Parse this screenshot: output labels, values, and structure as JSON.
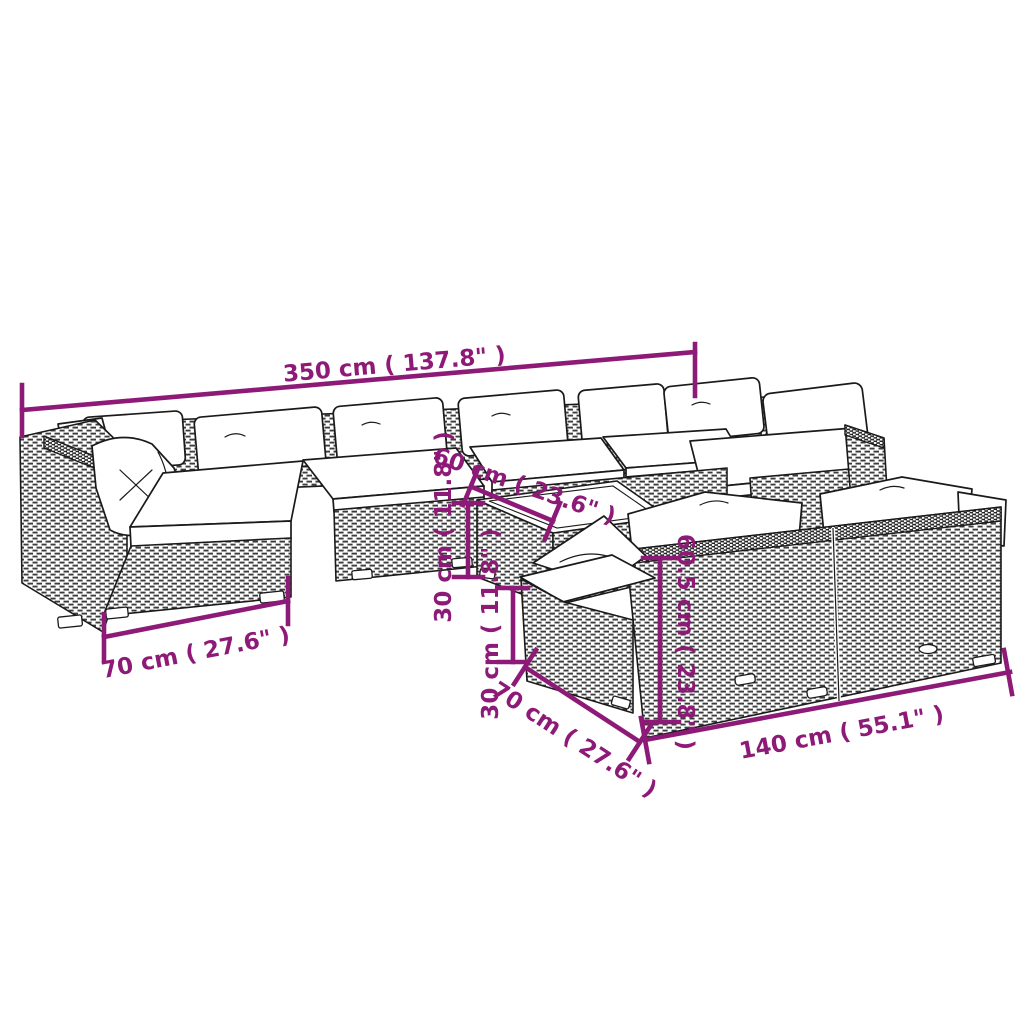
{
  "diagram": {
    "kind": "product-dimension-diagram",
    "subject": "poly rattan garden lounge set with cushions",
    "background_color": "#ffffff",
    "accent_color": "#8E1A78",
    "outline_color": "#1a1a1a",
    "cushion_color": "#ffffff"
  },
  "dimensions": {
    "sofa_row_width": "350 cm ( 137.8\" )",
    "table_width": "60 cm ( 23.6\" )",
    "table_height": "30 cm ( 11.8\" )",
    "seat_height": "30 cm ( 11.8\" )",
    "corner_module_depth": "70 cm ( 27.6\" )",
    "two_seater_depth": "70 cm ( 27.6\" )",
    "two_seater_width": "140 cm ( 55.1\" )",
    "backrest_height": "60.5 cm ( 23.8\" )"
  }
}
